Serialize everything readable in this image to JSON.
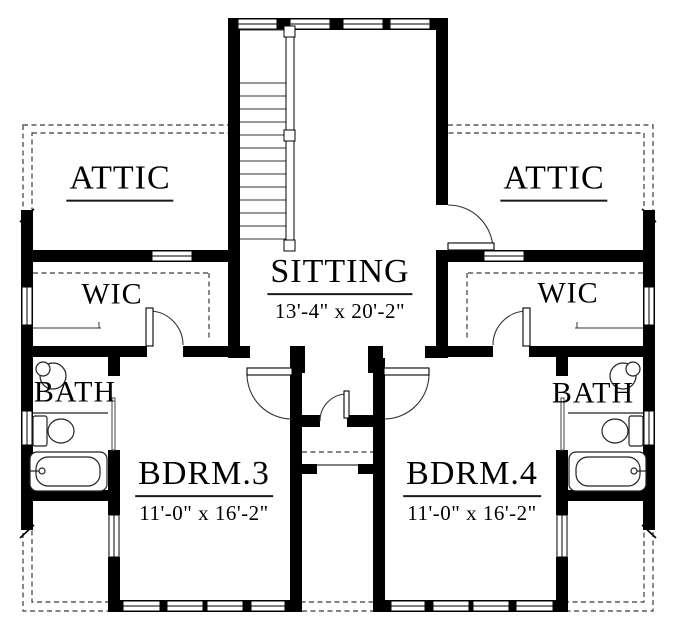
{
  "rooms": {
    "attic_left": {
      "label": "ATTIC"
    },
    "attic_right": {
      "label": "ATTIC"
    },
    "sitting": {
      "label": "SITTING",
      "dims": "13'-4\" x 20'-2\""
    },
    "wic_left": {
      "label": "WIC"
    },
    "wic_right": {
      "label": "WIC"
    },
    "bath_left": {
      "label": "BATH"
    },
    "bath_right": {
      "label": "BATH"
    },
    "bdrm3": {
      "label": "BDRM.3",
      "dims": "11'-0\" x 16'-2\""
    },
    "bdrm4": {
      "label": "BDRM.4",
      "dims": "11'-0\" x 16'-2\""
    }
  },
  "colors": {
    "wall": "#000000",
    "line": "#2a2a2a",
    "dash": "#3a3a3a",
    "bg": "#ffffff"
  }
}
